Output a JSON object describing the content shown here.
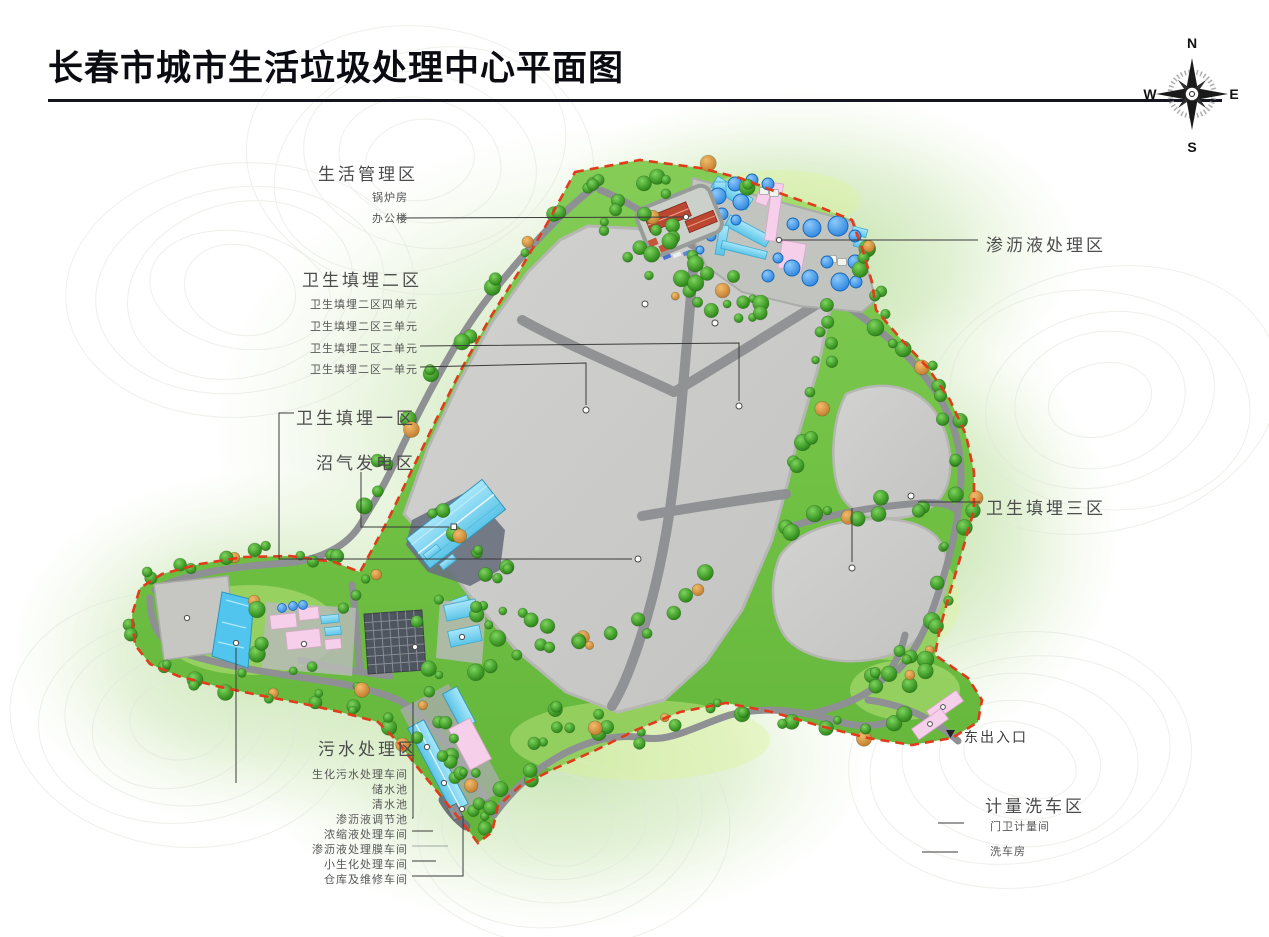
{
  "title": "长春市城市生活垃圾处理中心平面图",
  "compass": {
    "north": "N",
    "east": "E",
    "south": "S",
    "west": "W"
  },
  "areas": {
    "living_mgmt": {
      "label": "生活管理区",
      "items": [
        "锅炉房",
        "办公楼"
      ]
    },
    "landfill2": {
      "label": "卫生填埋二区",
      "items": [
        "卫生填埋二区四单元",
        "卫生填埋二区三单元",
        "卫生填埋二区二单元",
        "卫生填埋二区一单元"
      ]
    },
    "landfill1": {
      "label": "卫生填埋一区"
    },
    "biogas": {
      "label": "沼气发电区"
    },
    "leachate": {
      "label": "渗沥液处理区"
    },
    "landfill3": {
      "label": "卫生填埋三区"
    },
    "sewage": {
      "label": "污水处理区",
      "items": [
        "生化污水处理车间",
        "储水池",
        "清水池",
        "渗沥液调节池",
        "浓缩液处理车间",
        "渗沥液处理膜车间",
        "小生化处理车间",
        "仓库及维修车间"
      ]
    },
    "east_entrance": {
      "label": "东出入口",
      "marker": "▼"
    },
    "weigh_wash": {
      "label": "计量洗车区",
      "items": [
        "门卫计量间",
        "洗车房"
      ]
    }
  },
  "colors": {
    "boundary_red": "#e23b1c",
    "site_green": "#74c344",
    "landfill_gray": "#cbcbc9",
    "road_gray": "#8e9094",
    "tank_blue": "#3d9bee",
    "building_cyan": "#8adcf6",
    "building_pink": "#f6cfeb",
    "roof_red": "#bc4730"
  }
}
